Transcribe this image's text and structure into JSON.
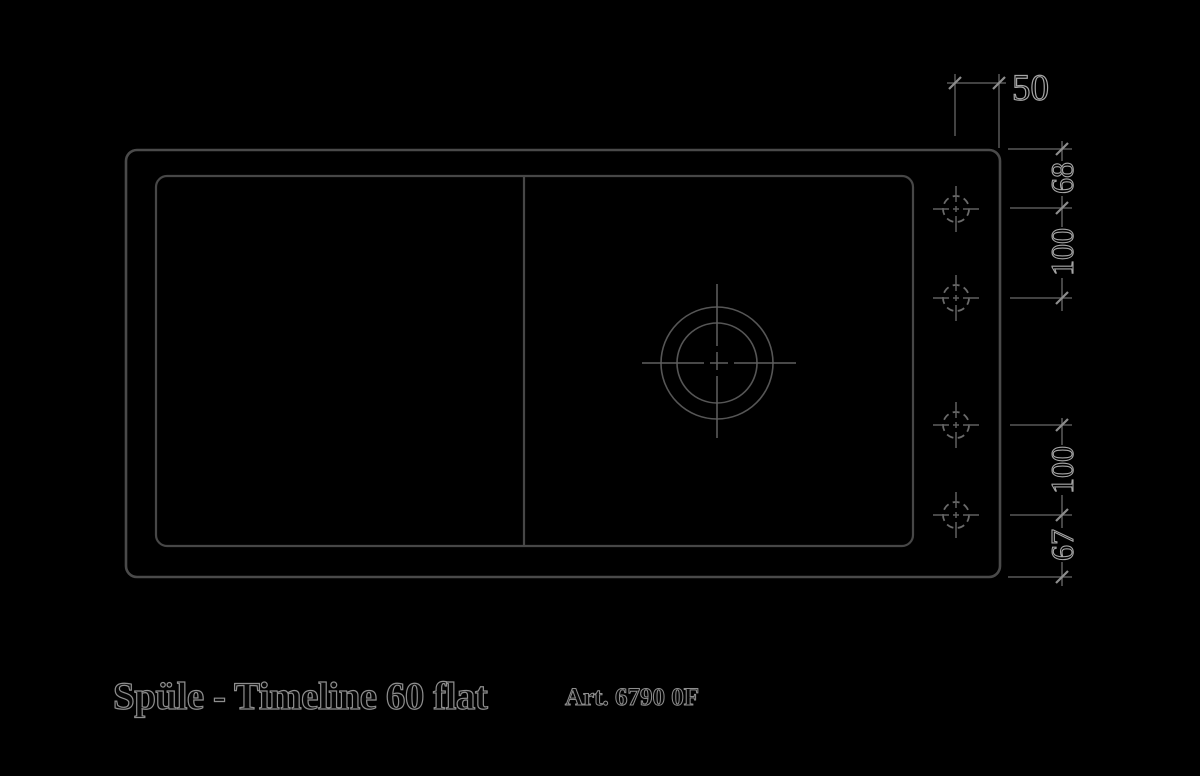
{
  "product": {
    "title": "Spüle - Timeline 60 flat",
    "article": "Art. 6790 0F"
  },
  "dimensions": {
    "top": "50",
    "right": [
      "68",
      "100",
      "100",
      "67"
    ]
  },
  "drawing_elements": {
    "sink_outer": "sink outer rim outline, rounded rectangle",
    "basin_inner": "inner basin outline, rounded rectangle",
    "basin_divider": "vertical divider between drainboard and bowl",
    "drain": "concentric drain circles with centerline crosshair",
    "tap_holes": "four dashed tap-hole circles with crosshairs on right deck"
  },
  "colors": {
    "background": "#000000",
    "line": "#4a4a4a",
    "tick": "#8d8d8d",
    "text_outline": "#a6a6a6",
    "text_fill": "#000000"
  }
}
